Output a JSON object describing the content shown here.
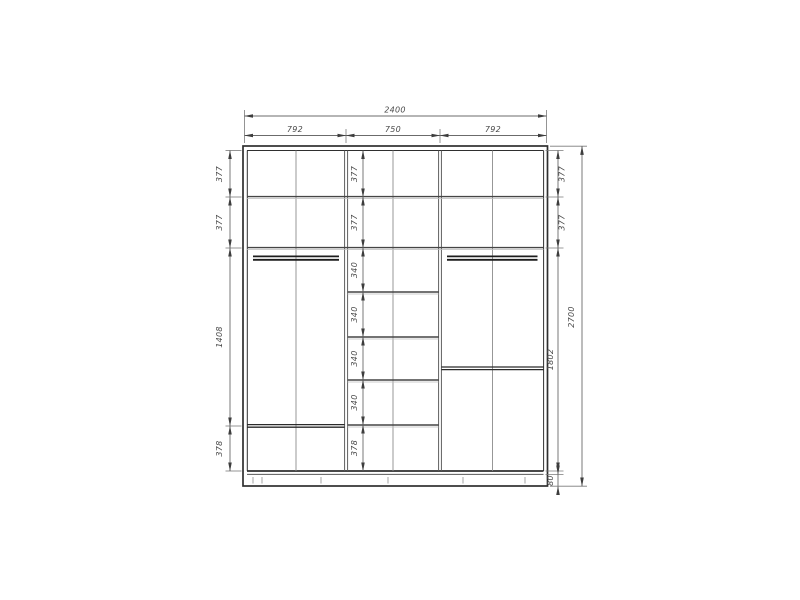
{
  "background": "#ffffff",
  "drawing": {
    "colors": {
      "structure_line": "#2f2f2f",
      "rail_line": "#1c1c1c",
      "dimension_line": "#6b6b6b",
      "dimension_text": "#4a4a4a"
    },
    "dimensions": {
      "top": {
        "total": "2400",
        "sections": [
          "792",
          "750",
          "792"
        ]
      },
      "left": [
        "377",
        "377",
        "1408",
        "378"
      ],
      "middle": [
        "377",
        "377",
        "340",
        "340",
        "340",
        "340",
        "378"
      ],
      "right": [
        "377",
        "377",
        "1802",
        "80"
      ],
      "height_total": "2700"
    }
  }
}
